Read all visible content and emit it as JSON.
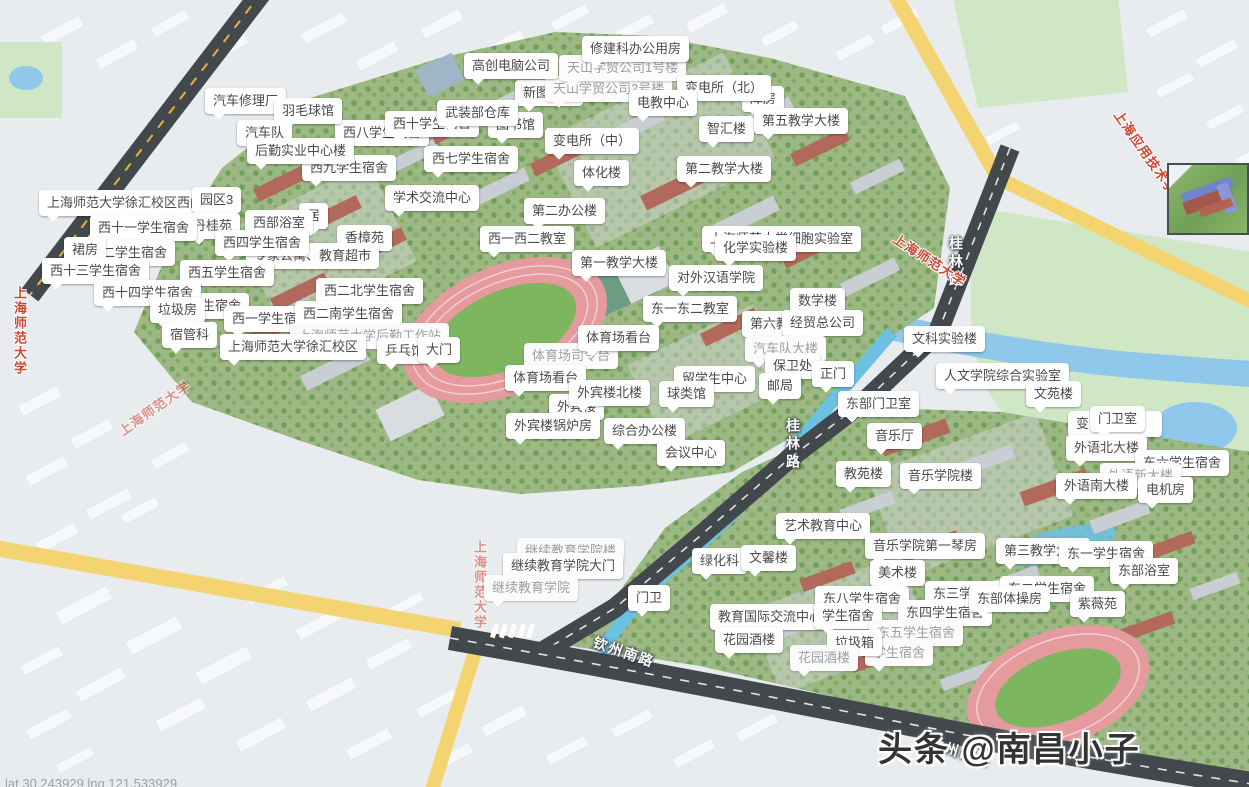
{
  "map": {
    "title": "上海师范大学徐汇校区地图",
    "watermark": "头条 @南昌小子",
    "coords_text": "lat 30.243929 lng 121.533929",
    "colors": {
      "label_bg": "#ffffff",
      "label_text": "#4a4a4a",
      "road_dark": "#43484d",
      "road_yellow": "#f3d470",
      "water": "#8fc8ea",
      "park": "#cfe7c4",
      "campus_green": "#9db884",
      "track_pink": "#e59a9e",
      "track_field": "#7cb65f",
      "poi_red": "#cf4632"
    },
    "labels": [
      {
        "t": "新图书馆",
        "x": 515,
        "y": 80
      },
      {
        "t": "天山学贸公司2号楼",
        "x": 545,
        "y": 76,
        "dim": true
      },
      {
        "t": "天山学贸公司1号楼",
        "x": 559,
        "y": 55,
        "dim": true
      },
      {
        "t": "修建科办公用房",
        "x": 582,
        "y": 36
      },
      {
        "t": "高创电脑公司",
        "x": 464,
        "y": 53
      },
      {
        "t": "库房",
        "x": 742,
        "y": 86
      },
      {
        "t": "变电所（北）",
        "x": 677,
        "y": 75
      },
      {
        "t": "电教中心",
        "x": 629,
        "y": 90
      },
      {
        "t": "西八学生宿舍",
        "x": 335,
        "y": 120
      },
      {
        "t": "西十学生宿舍",
        "x": 385,
        "y": 111
      },
      {
        "t": "图书馆",
        "x": 488,
        "y": 112
      },
      {
        "t": "武装部仓库",
        "x": 437,
        "y": 100
      },
      {
        "t": "汽车修理厂",
        "x": 205,
        "y": 88
      },
      {
        "t": "羽毛球馆",
        "x": 274,
        "y": 98
      },
      {
        "t": "汽车队",
        "x": 237,
        "y": 120
      },
      {
        "t": "西九学生宿舍",
        "x": 302,
        "y": 155
      },
      {
        "t": "后勤实业中心楼",
        "x": 247,
        "y": 138
      },
      {
        "t": "西七学生宿舍",
        "x": 424,
        "y": 146
      },
      {
        "t": "变电所（中）",
        "x": 545,
        "y": 128
      },
      {
        "t": "体化楼",
        "x": 574,
        "y": 160
      },
      {
        "t": "智汇楼",
        "x": 699,
        "y": 116
      },
      {
        "t": "第五教学大楼",
        "x": 754,
        "y": 108
      },
      {
        "t": "第二教学大楼",
        "x": 677,
        "y": 156
      },
      {
        "t": "上海师范大学徐汇校区西门",
        "x": 39,
        "y": 190
      },
      {
        "t": "园区3",
        "x": 192,
        "y": 187
      },
      {
        "t": "学术交流中心",
        "x": 385,
        "y": 185
      },
      {
        "t": "第二办公楼",
        "x": 524,
        "y": 198
      },
      {
        "t": "居",
        "x": 299,
        "y": 203
      },
      {
        "t": "西部浴室",
        "x": 245,
        "y": 210
      },
      {
        "t": "丹桂苑",
        "x": 185,
        "y": 213
      },
      {
        "t": "西十一学生宿舍",
        "x": 90,
        "y": 215
      },
      {
        "t": "西一西二教室",
        "x": 480,
        "y": 226
      },
      {
        "t": "上海师范大学细胞实验室",
        "x": 702,
        "y": 226
      },
      {
        "t": "化学实验楼",
        "x": 715,
        "y": 235
      },
      {
        "t": "香樟苑",
        "x": 337,
        "y": 225
      },
      {
        "t": "专家公寓、教育超市",
        "x": 246,
        "y": 243
      },
      {
        "t": "西四学生宿舍",
        "x": 215,
        "y": 230
      },
      {
        "t": "西十二学生宿舍",
        "x": 68,
        "y": 240
      },
      {
        "t": "裙房",
        "x": 64,
        "y": 237
      },
      {
        "t": "西十三学生宿舍",
        "x": 42,
        "y": 258
      },
      {
        "t": "西五学生宿舍",
        "x": 180,
        "y": 260
      },
      {
        "t": "第一教学大楼",
        "x": 572,
        "y": 250
      },
      {
        "t": "对外汉语学院",
        "x": 669,
        "y": 265
      },
      {
        "t": "数学楼",
        "x": 790,
        "y": 288
      },
      {
        "t": "西三学生宿舍",
        "x": 155,
        "y": 293
      },
      {
        "t": "西十四学生宿舍",
        "x": 94,
        "y": 280
      },
      {
        "t": "垃圾房",
        "x": 150,
        "y": 297
      },
      {
        "t": "宿管科",
        "x": 162,
        "y": 322
      },
      {
        "t": "东一东二教室",
        "x": 643,
        "y": 296
      },
      {
        "t": "第六教学楼",
        "x": 742,
        "y": 311
      },
      {
        "t": "经贸总公司",
        "x": 782,
        "y": 310
      },
      {
        "t": "西二北学生宿舍",
        "x": 316,
        "y": 278
      },
      {
        "t": "西一学生宿舍",
        "x": 224,
        "y": 306
      },
      {
        "t": "西二南学生宿舍",
        "x": 295,
        "y": 301
      },
      {
        "t": "上海师范大学后勤工作站",
        "x": 290,
        "y": 323,
        "dim": true
      },
      {
        "t": "上海师范大学徐汇校区",
        "x": 220,
        "y": 334
      },
      {
        "t": "乒乓馆",
        "x": 377,
        "y": 338
      },
      {
        "t": "大门",
        "x": 418,
        "y": 337
      },
      {
        "t": "体育场司令台",
        "x": 524,
        "y": 343,
        "dim": true
      },
      {
        "t": "体育场看台",
        "x": 578,
        "y": 325
      },
      {
        "t": "体育场看台",
        "x": 505,
        "y": 365
      },
      {
        "t": "汽车队大楼",
        "x": 745,
        "y": 336,
        "dim": true
      },
      {
        "t": "保卫处",
        "x": 765,
        "y": 353
      },
      {
        "t": "正门",
        "x": 812,
        "y": 361
      },
      {
        "t": "邮局",
        "x": 759,
        "y": 373
      },
      {
        "t": "留学生中心",
        "x": 674,
        "y": 366
      },
      {
        "t": "球类馆",
        "x": 659,
        "y": 381
      },
      {
        "t": "文科实验楼",
        "x": 904,
        "y": 326
      },
      {
        "t": "人文学院综合实验室",
        "x": 936,
        "y": 363
      },
      {
        "t": "文苑楼",
        "x": 1026,
        "y": 381
      },
      {
        "t": "外宾楼",
        "x": 549,
        "y": 394
      },
      {
        "t": "外宾楼北楼",
        "x": 569,
        "y": 380
      },
      {
        "t": "外宾楼锅炉房",
        "x": 506,
        "y": 413
      },
      {
        "t": "综合办公楼",
        "x": 604,
        "y": 418
      },
      {
        "t": "会议中心",
        "x": 657,
        "y": 440
      },
      {
        "t": "东部门卫室",
        "x": 838,
        "y": 391
      },
      {
        "t": "变电所（东）",
        "x": 1068,
        "y": 411
      },
      {
        "t": "门卫室",
        "x": 1090,
        "y": 406
      },
      {
        "t": "音乐厅",
        "x": 867,
        "y": 423
      },
      {
        "t": "外语北大楼",
        "x": 1066,
        "y": 435
      },
      {
        "t": "东六学生宿舍",
        "x": 1135,
        "y": 450
      },
      {
        "t": "外语新大楼",
        "x": 1100,
        "y": 463,
        "dim": true
      },
      {
        "t": "外语南大楼",
        "x": 1056,
        "y": 473
      },
      {
        "t": "电机房",
        "x": 1138,
        "y": 477
      },
      {
        "t": "教苑楼",
        "x": 836,
        "y": 461
      },
      {
        "t": "音乐学院楼",
        "x": 900,
        "y": 463
      },
      {
        "t": "艺术教育中心",
        "x": 776,
        "y": 513
      },
      {
        "t": "音乐学院第一琴房",
        "x": 865,
        "y": 533
      },
      {
        "t": "美术楼",
        "x": 870,
        "y": 560
      },
      {
        "t": "继续教育学院楼",
        "x": 517,
        "y": 538,
        "dim": true
      },
      {
        "t": "继续教育学院大门",
        "x": 503,
        "y": 553
      },
      {
        "t": "继续教育学院",
        "x": 484,
        "y": 575,
        "dim": true
      },
      {
        "t": "绿化科",
        "x": 692,
        "y": 548
      },
      {
        "t": "文馨楼",
        "x": 741,
        "y": 545
      },
      {
        "t": "第三教学大楼",
        "x": 996,
        "y": 538
      },
      {
        "t": "东一学生宿舍",
        "x": 1059,
        "y": 541
      },
      {
        "t": "东部浴室",
        "x": 1110,
        "y": 558
      },
      {
        "t": "门卫",
        "x": 628,
        "y": 585
      },
      {
        "t": "教育国际交流中心",
        "x": 710,
        "y": 604
      },
      {
        "t": "东八学生宿舍",
        "x": 815,
        "y": 586
      },
      {
        "t": "学生宿舍",
        "x": 814,
        "y": 603
      },
      {
        "t": "东三学生宿舍",
        "x": 925,
        "y": 581
      },
      {
        "t": "东二学生宿舍",
        "x": 1000,
        "y": 576
      },
      {
        "t": "东四学生宿舍",
        "x": 898,
        "y": 600
      },
      {
        "t": "东部体操房",
        "x": 969,
        "y": 586
      },
      {
        "t": "紫薇苑",
        "x": 1070,
        "y": 591
      },
      {
        "t": "东五学生宿舍",
        "x": 869,
        "y": 620,
        "dim": true
      },
      {
        "t": "学生宿舍",
        "x": 865,
        "y": 640,
        "dim": true
      },
      {
        "t": "垃圾箱",
        "x": 827,
        "y": 630
      },
      {
        "t": "花园酒楼",
        "x": 715,
        "y": 627
      },
      {
        "t": "花园酒楼",
        "x": 790,
        "y": 645,
        "dim": true
      }
    ],
    "road_labels": [
      {
        "t": "桂林路",
        "x": 946,
        "y": 236,
        "mode": "v"
      },
      {
        "t": "桂林路",
        "x": 783,
        "y": 418,
        "mode": "v"
      },
      {
        "t": "钦州南路",
        "x": 592,
        "y": 642,
        "rot": 19
      },
      {
        "t": "钦州南路",
        "x": 928,
        "y": 742,
        "rot": 17
      }
    ],
    "poi_labels": [
      {
        "t": "上海师范大学",
        "x": 10,
        "y": 286,
        "mode": "v"
      },
      {
        "t": "上海师范大学",
        "x": 112,
        "y": 398,
        "rot": -35,
        "faint": true
      },
      {
        "t": "上海师范大学",
        "x": 470,
        "y": 540,
        "mode": "v",
        "faint": true
      },
      {
        "t": "上海师范大学",
        "x": 888,
        "y": 250,
        "rot": 33
      },
      {
        "t": "上海应用技术学院",
        "x": 1094,
        "y": 148,
        "rot": 55
      }
    ]
  }
}
